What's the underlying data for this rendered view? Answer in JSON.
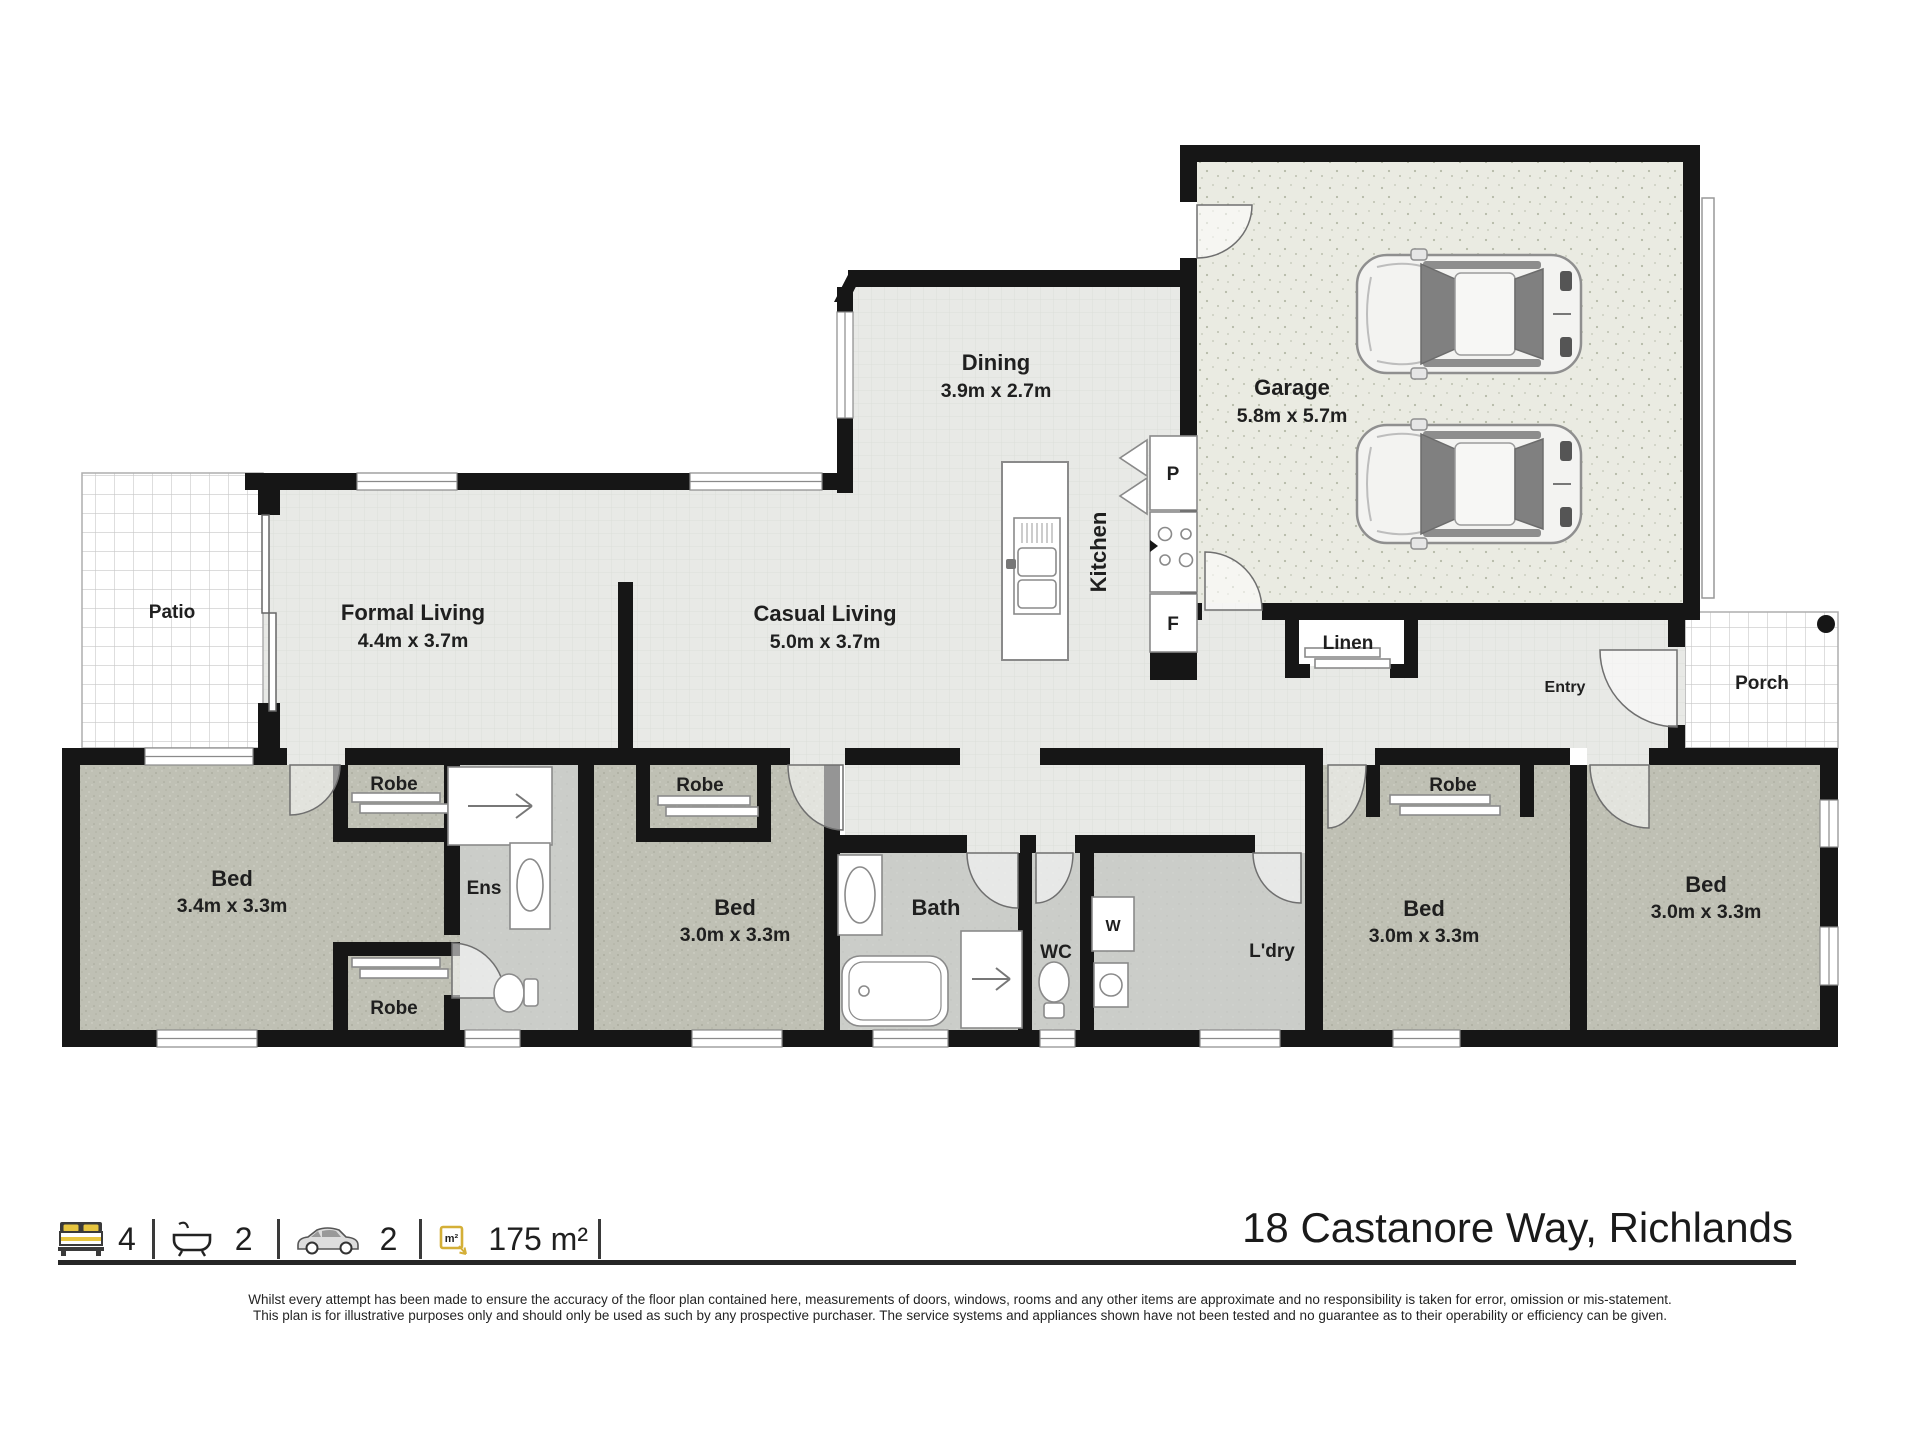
{
  "address": "18 Castanore Way, Richlands",
  "legend": {
    "beds": "4",
    "baths": "2",
    "cars": "2",
    "area": "175 m²"
  },
  "disclaimer": {
    "line1": "Whilst every attempt has been made to ensure the accuracy of the floor plan contained here, measurements of doors, windows, rooms and any other items are approximate and no responsibility is taken for error, omission or mis-statement.",
    "line2": "This plan is for illustrative purposes only and should only be used as such by any prospective purchaser. The service systems and appliances shown have not been tested and no guarantee as to their operability or efficiency can be given."
  },
  "rooms": {
    "patio": {
      "name": "Patio"
    },
    "formal_living": {
      "name": "Formal Living",
      "dims": "4.4m x 3.7m"
    },
    "casual_living": {
      "name": "Casual Living",
      "dims": "5.0m x 3.7m"
    },
    "dining": {
      "name": "Dining",
      "dims": "3.9m x 2.7m"
    },
    "kitchen": {
      "name": "Kitchen"
    },
    "pantry": {
      "label": "P"
    },
    "fridge": {
      "label": "F"
    },
    "garage": {
      "name": "Garage",
      "dims": "5.8m x 5.7m"
    },
    "linen": {
      "name": "Linen"
    },
    "entry": {
      "name": "Entry"
    },
    "porch": {
      "name": "Porch"
    },
    "bed1": {
      "name": "Bed",
      "dims": "3.4m x 3.3m"
    },
    "bed2": {
      "name": "Bed",
      "dims": "3.0m x 3.3m"
    },
    "bed3": {
      "name": "Bed",
      "dims": "3.0m x 3.3m"
    },
    "bed4": {
      "name": "Bed",
      "dims": "3.0m x 3.3m"
    },
    "ens": {
      "name": "Ens"
    },
    "bath": {
      "name": "Bath"
    },
    "wc": {
      "name": "WC"
    },
    "laundry": {
      "name": "L'dry"
    },
    "washer": {
      "label": "W"
    },
    "robe1": {
      "name": "Robe"
    },
    "robe2": {
      "name": "Robe"
    },
    "robe3": {
      "name": "Robe"
    },
    "robe4": {
      "name": "Robe"
    }
  },
  "colors": {
    "wall": "#161616",
    "living_floor": "#e8e9e6",
    "bedroom_floor": "#bfc0b4",
    "wet_floor": "#cbcdc9",
    "garage_floor": "#eaebe2",
    "accent_yellow": "#d4af37"
  }
}
